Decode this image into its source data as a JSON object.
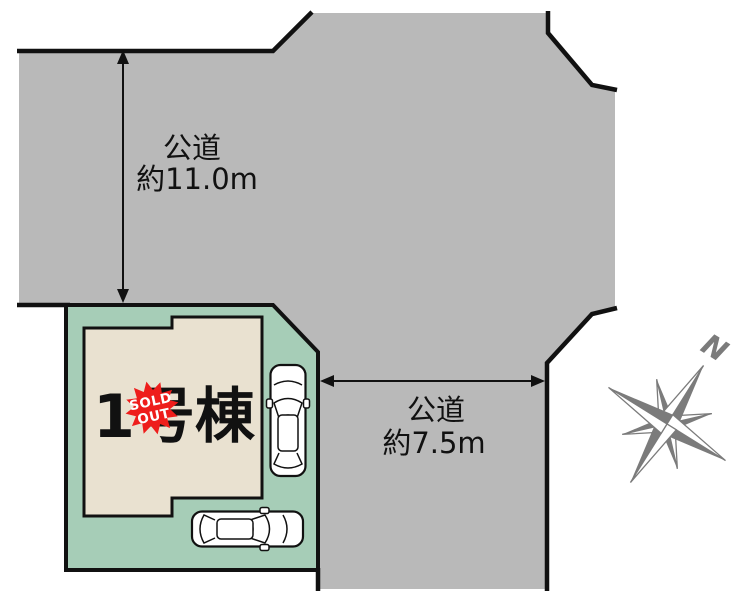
{
  "diagram": {
    "type": "real-estate-lot-layout",
    "road_labels": {
      "top": {
        "line1": "公道",
        "line2": "約11.0m"
      },
      "right": {
        "line1": "公道",
        "line2": "約7.5m"
      }
    },
    "building": {
      "label": "1号棟",
      "badge": {
        "line1": "SOLD",
        "line2": "OUT"
      }
    },
    "compass": {
      "north": "N"
    },
    "colors": {
      "road": "#b9b9b9",
      "lot": "#a6cdb7",
      "house": "#e9e1d0",
      "outline": "#111111",
      "badge": "#ee1d1b",
      "badge_text": "#ffffff",
      "compass": "#7b7b7b",
      "label_text": "#111111",
      "car": "#ffffff"
    }
  }
}
